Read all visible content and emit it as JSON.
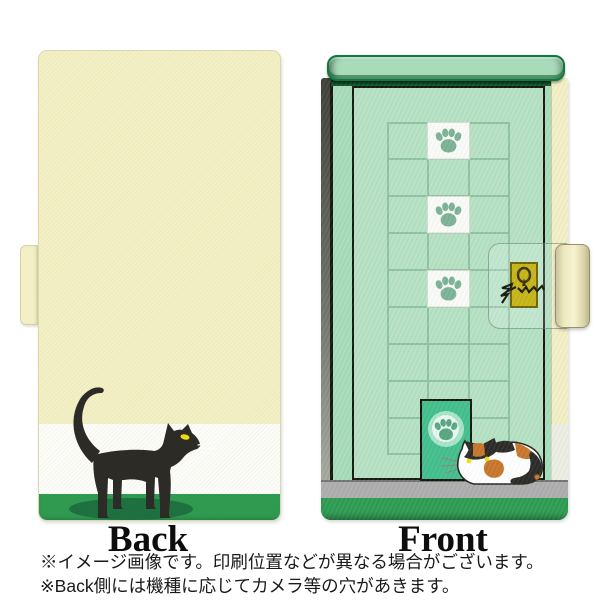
{
  "views": {
    "back": {
      "label": "Back"
    },
    "front": {
      "label": "Front"
    }
  },
  "notes": {
    "line1": "※イメージ画像です。印刷位置などが異なる場合がございます。",
    "line2": "※Back側には機種に応じてカメラ等の穴があきます。"
  },
  "palette": {
    "cream": "#F4F0C5",
    "mint": "#A8DBBA",
    "door": "#B5E1C3",
    "grid": "#8FC2A3",
    "cell_white": "#FAFBF6",
    "paw_green": "#7CB396",
    "band_green": "#2E9B51",
    "floor_gray": "#ADADAD",
    "shadow_green": "#1D7040",
    "cat_black": "#2B2A27",
    "eye_yellow": "#F0DF10",
    "catdoor_green": "#43BF8C",
    "gold": "#C7B418",
    "spine_cream": "#F3EFC4",
    "white_band": "#FCFCF9",
    "calico_orange": "#C8762A"
  }
}
